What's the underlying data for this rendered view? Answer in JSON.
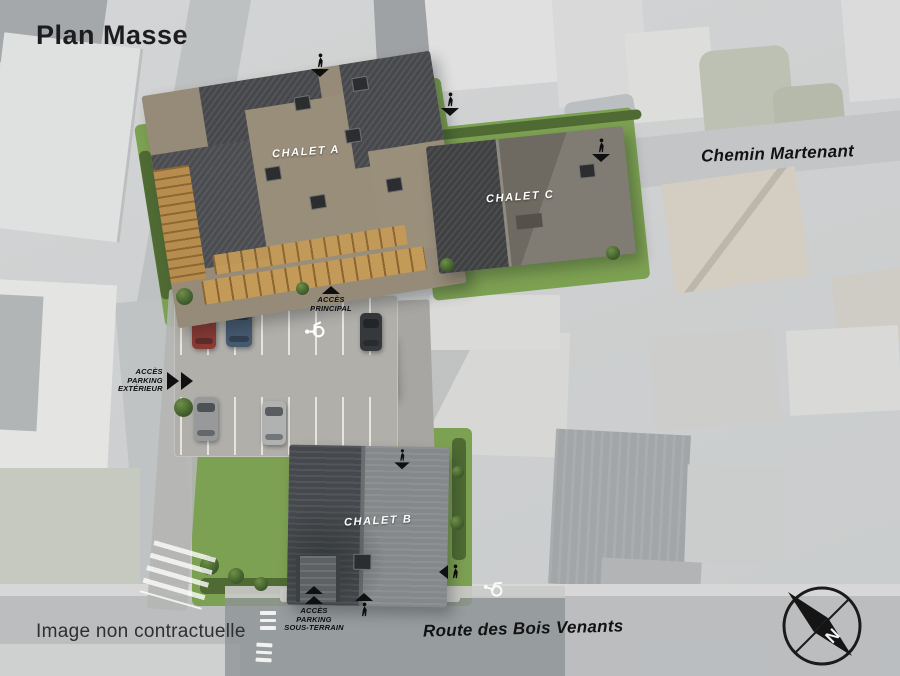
{
  "page": {
    "title": "Plan Masse",
    "disclaimer": "Image non contractuelle"
  },
  "roads": {
    "chemin": "Chemin Martenant",
    "route": "Route des Bois Venants"
  },
  "chalets": {
    "a": "CHALET A",
    "b": "CHALET B",
    "c": "CHALET C"
  },
  "access": {
    "principal": [
      "ACCÈS",
      "PRINCIPAL"
    ],
    "parking_exterieur": [
      "ACCÈS",
      "PARKING",
      "EXTÉRIEUR"
    ],
    "parking_sous_terrain": [
      "ACCÈS",
      "PARKING",
      "SOUS-TERRAIN"
    ]
  },
  "compass": {
    "north": "N"
  },
  "colors": {
    "lawn": "#7da152",
    "lawn_dark": "#4f6b33",
    "roof_dark": "#45474b",
    "roof_tan": "#968b78",
    "wood": "#c49a58",
    "asphalt": "#b1afaa",
    "road": "#96999c",
    "ink": "#141414",
    "label_white": "#ffffff"
  }
}
